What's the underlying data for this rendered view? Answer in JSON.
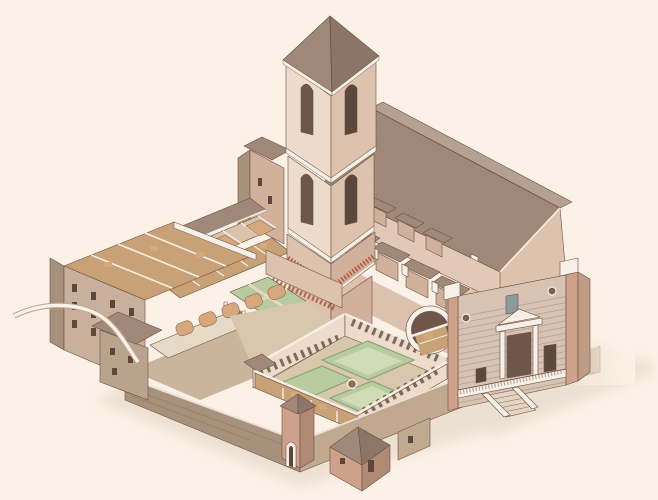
{
  "scene": {
    "subject": "Axonometric cutaway illustration of a monastic church complex with a tall bell tower, long tiled nave, monumental striped facade with baroque portal and staircase, two arcaded cloisters with green garden courts, cut-open dormitory and gallery wings, and stone retaining walls with a corner turret",
    "style": "hand-drawn watercolour and ink architectural drawing",
    "background": "cream paper"
  },
  "palette": {
    "paper": "#fbf1e6",
    "shadow": "#e8dbcd",
    "line": "#6a5243",
    "roof": "#a1897a",
    "roof_light": "#b6a091",
    "roof_dark": "#8d7667",
    "wall_light": "#eddbcb",
    "wall_mid": "#ddc2ae",
    "wall_shade": "#d2b19c",
    "brick": "#cfa08a",
    "facade": "#d8c3b2",
    "stone": "#c0a98f",
    "stone_dark": "#a8917c",
    "stone_light": "#cbb49c",
    "garden": "#b7cb9e",
    "garden_light": "#cfdcb6",
    "path": "#d9c7ad",
    "floor": "#c9a176",
    "vault": "#d7a87d",
    "opening": "#6e564a",
    "opening_dark": "#5d463b",
    "trim": "#f7f0e7",
    "frieze": "#b05a41",
    "window_slate": "#8b99a3",
    "road": "#b9a795",
    "hedge": "#8aa274"
  },
  "components": [
    {
      "id": "bell-tower",
      "label": "Bell tower with pyramidal tiled roof, lancet openings and corbel frieze"
    },
    {
      "id": "church-nave",
      "label": "Church nave with long hatched tile roof"
    },
    {
      "id": "side-chapels",
      "label": "Row of side chapels with white buttress caps along the nave"
    },
    {
      "id": "main-facade",
      "label": "Monumental striped facade with baroque portal, oculi, terrace and double staircase"
    },
    {
      "id": "first-cloister",
      "label": "Small upper cloister with green garth and red-arched arcade"
    },
    {
      "id": "second-cloister",
      "label": "Large lower cloister with quadrant gardens and central well"
    },
    {
      "id": "dormitory-wing",
      "label": "Cut-open dormitory wing with rows of windows"
    },
    {
      "id": "vaulted-galleries",
      "label": "Cut-away vaulted galleries showing bays and furnishings"
    },
    {
      "id": "undercroft-vaults",
      "label": "Row of orange vault extrados over the undercroft"
    },
    {
      "id": "retaining-wall",
      "label": "Stone retaining wall and basement with corner turret"
    },
    {
      "id": "houses",
      "label": "Small tiled-roof houses at the foot of the complex"
    },
    {
      "id": "access-road",
      "label": "Curved access road at lower left"
    },
    {
      "id": "cutaway-arch",
      "label": "Sectioned arch revealing an interior gallery beside the facade"
    },
    {
      "id": "west-range",
      "label": "Tall stone west range block beside the tower"
    }
  ]
}
